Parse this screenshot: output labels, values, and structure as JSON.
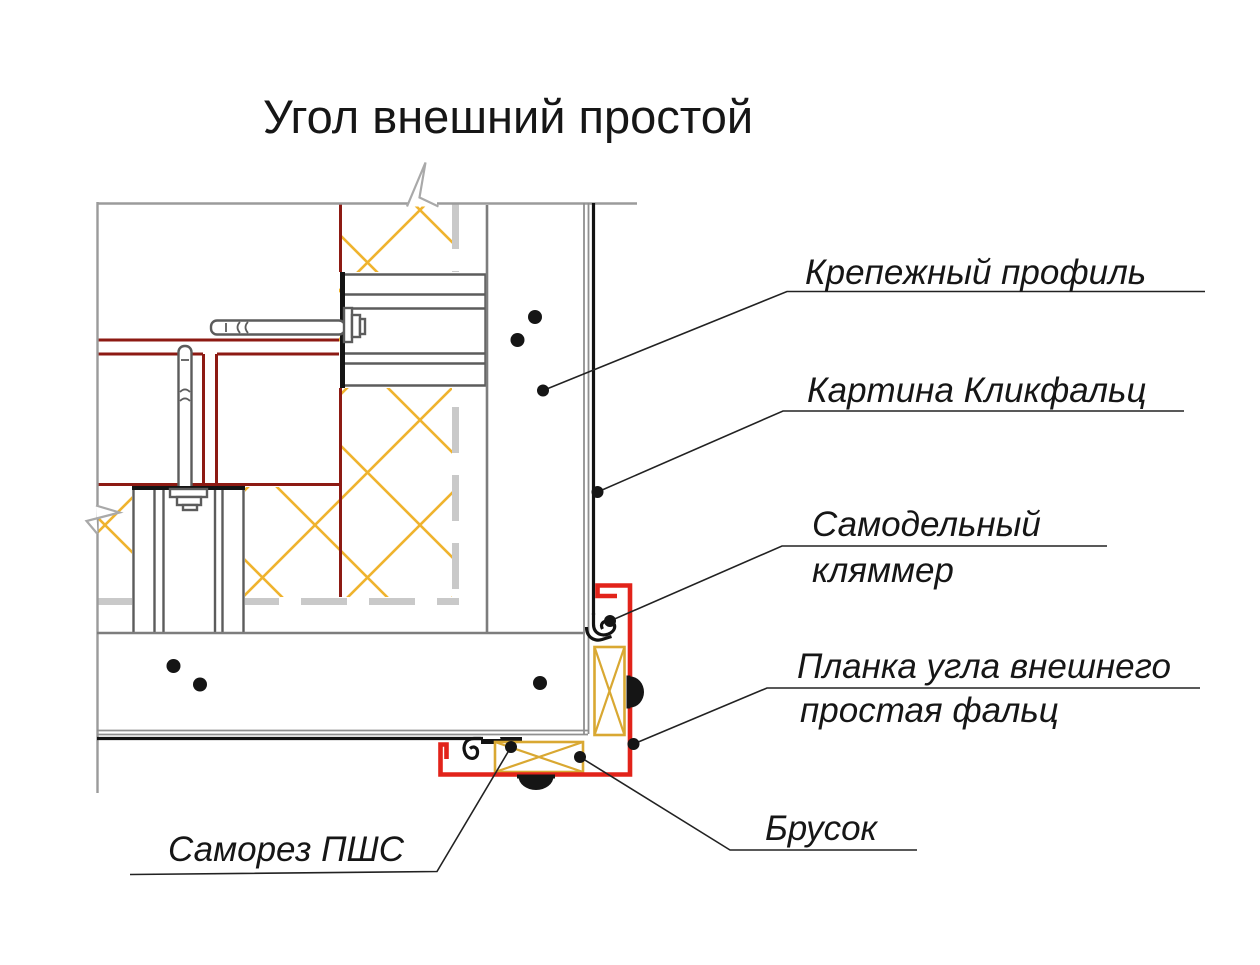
{
  "page": {
    "background": "#ffffff"
  },
  "title": "Угол внешний простой",
  "colors": {
    "profile_red": "#e2231a",
    "masonry_red": "#8d1a13",
    "insulation_yellow": "#efb32e",
    "timber_yellow": "#d9a832",
    "line_gray": "#9b9b9b",
    "line_gray_dark": "#7d7d7d",
    "membrane_gray": "#c9c9c9",
    "bracket_gray": "#5c5c5c",
    "ink": "#161616"
  },
  "callouts": {
    "fastening_profile": "Крепежный профиль",
    "klikfalz_sheet": "Картина Кликфальц",
    "homemade_clamp_line1": "Самодельный",
    "homemade_clamp_line2": "кляммер",
    "corner_flashing_line1": "Планка угла внешнего",
    "corner_flashing_line2": "простая фальц",
    "self_tapping_screw": "Саморез ПШС",
    "timber_block": "Брусок"
  }
}
